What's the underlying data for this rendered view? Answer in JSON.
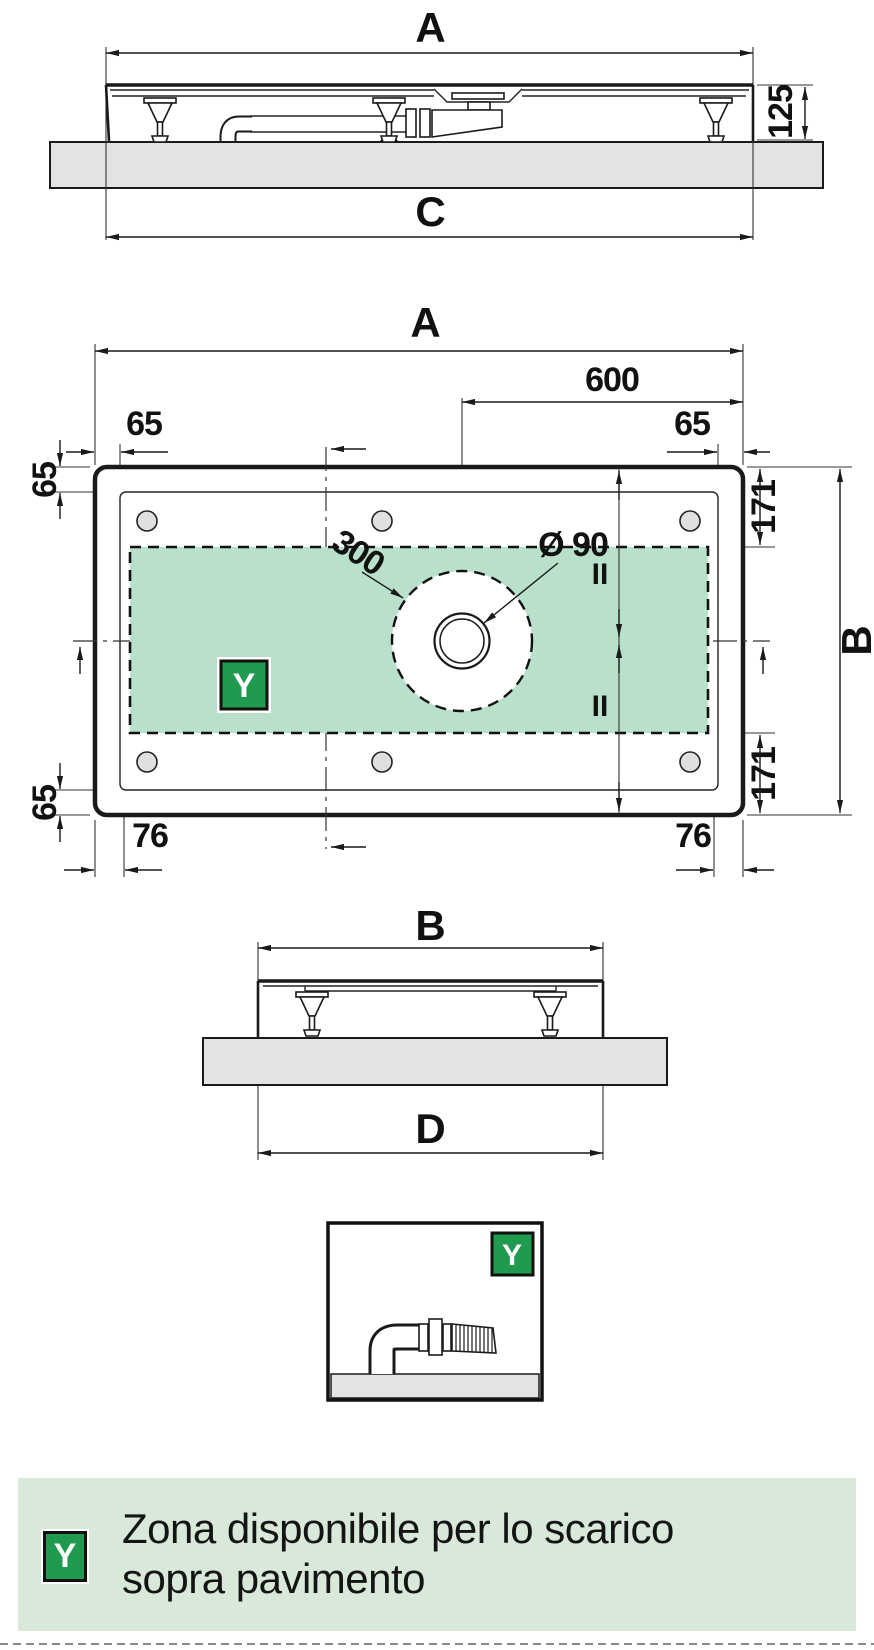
{
  "colors": {
    "line": "#1a1a1a",
    "zone_green": "#b9e0cb",
    "badge_green": "#1f9a4e",
    "legend_bg": "#d8e9d9",
    "slab_gray": "#e3e3e3",
    "foot_gray": "#e0e0e0"
  },
  "views": {
    "side_long": {
      "width_label": "A",
      "height_label": "125",
      "base_label": "C"
    },
    "plan": {
      "width_label": "A",
      "drain_to_edge_label": "600",
      "rim_offset_top_left": "65",
      "rim_offset_top_right": "65",
      "rim_offset_left_top": "65",
      "rim_offset_left_bottom": "65",
      "zone_inset_top": "171",
      "zone_inset_bottom": "171",
      "depth_label": "B",
      "zone_circle_label": "300",
      "drain_diameter_label": "Ø 90",
      "equal_top": "II",
      "equal_bottom": "II",
      "zone_badge": "Y",
      "foot_offset_left": "76",
      "foot_offset_right": "76"
    },
    "side_short": {
      "width_label": "B",
      "base_label": "D"
    },
    "detail": {
      "badge": "Y"
    }
  },
  "legend": {
    "badge": "Y",
    "line1": "Zona disponibile per lo scarico",
    "line2": "sopra pavimento"
  }
}
